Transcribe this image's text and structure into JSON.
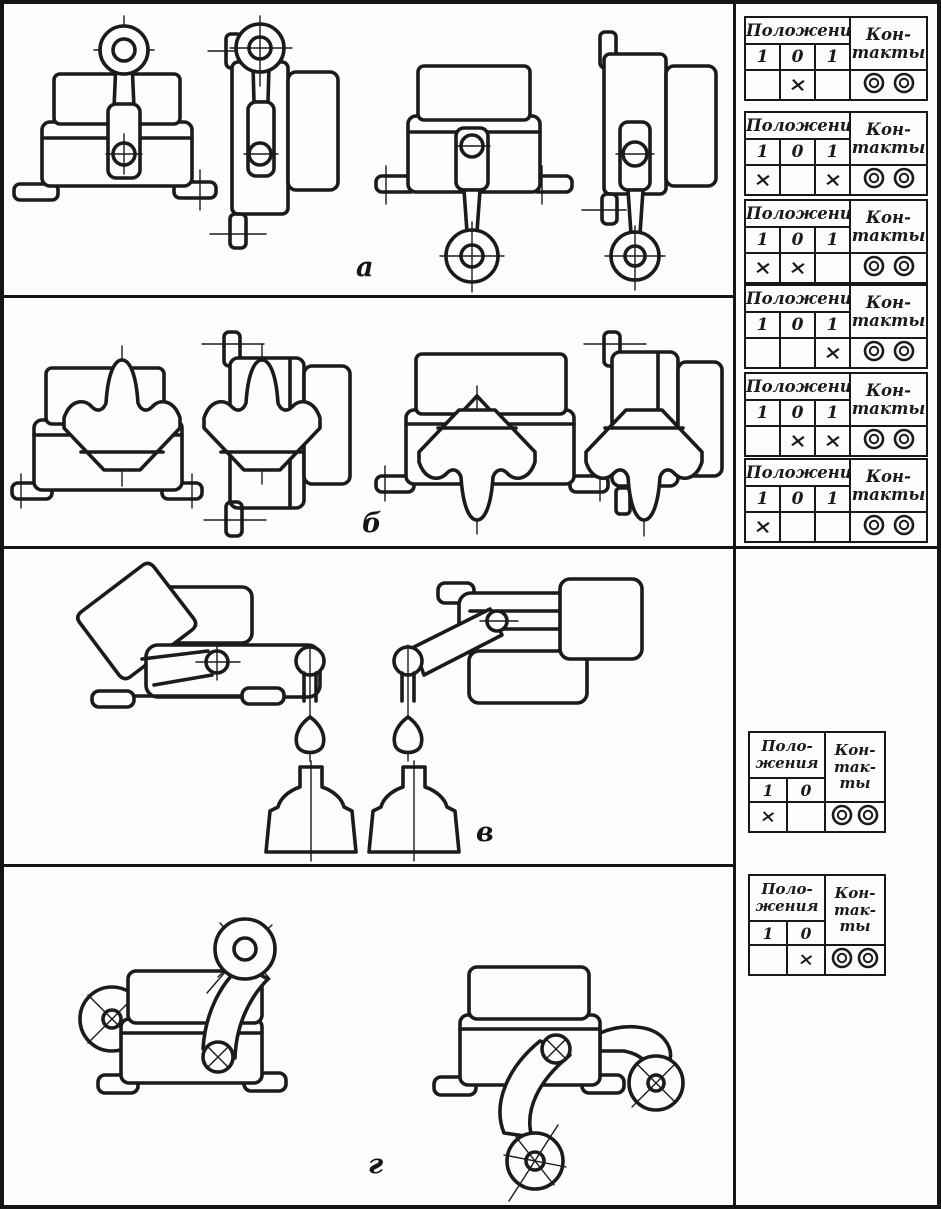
{
  "document": {
    "type": "scanned-technical-figure",
    "subject": "limit switch actuator variants with contact position tables",
    "language": "Russian"
  },
  "sections": {
    "a": {
      "label": "а"
    },
    "b": {
      "label": "б"
    },
    "v": {
      "label": "в"
    },
    "g": {
      "label": "г"
    }
  },
  "icons": {
    "contact": "double-circle-contact-icon"
  },
  "colors": {
    "ink": "#1b1b1b",
    "paper": "#fdfdfb"
  },
  "tables": {
    "large": [
      {
        "positions_title": "Положения",
        "contacts_line1": "Кон-",
        "contacts_line2": "такты",
        "col1": "1",
        "col2": "0",
        "col3": "1",
        "mark1": "",
        "mark2": "×",
        "mark3": ""
      },
      {
        "positions_title": "Положения",
        "contacts_line1": "Кон-",
        "contacts_line2": "такты",
        "col1": "1",
        "col2": "0",
        "col3": "1",
        "mark1": "×",
        "mark2": "",
        "mark3": "×"
      },
      {
        "positions_title": "Положения",
        "contacts_line1": "Кон-",
        "contacts_line2": "такты",
        "col1": "1",
        "col2": "0",
        "col3": "1",
        "mark1": "×",
        "mark2": "×",
        "mark3": ""
      },
      {
        "positions_title": "Положения",
        "contacts_line1": "Кон-",
        "contacts_line2": "такты",
        "col1": "1",
        "col2": "0",
        "col3": "1",
        "mark1": "",
        "mark2": "",
        "mark3": "×"
      },
      {
        "positions_title": "Положения",
        "contacts_line1": "Кон-",
        "contacts_line2": "такты",
        "col1": "1",
        "col2": "0",
        "col3": "1",
        "mark1": "",
        "mark2": "×",
        "mark3": "×"
      },
      {
        "positions_title": "Положения",
        "contacts_line1": "Кон-",
        "contacts_line2": "такты",
        "col1": "1",
        "col2": "0",
        "col3": "1",
        "mark1": "×",
        "mark2": "",
        "mark3": ""
      }
    ],
    "small": [
      {
        "positions_line1": "Поло-",
        "positions_line2": "жения",
        "contacts_line1": "Кон-",
        "contacts_line2": "так-",
        "contacts_line3": "ты",
        "col1": "1",
        "col2": "0",
        "mark1": "×",
        "mark2": ""
      },
      {
        "positions_line1": "Поло-",
        "positions_line2": "жения",
        "contacts_line1": "Кон-",
        "contacts_line2": "так-",
        "contacts_line3": "ты",
        "col1": "1",
        "col2": "0",
        "mark1": "",
        "mark2": "×"
      }
    ]
  }
}
